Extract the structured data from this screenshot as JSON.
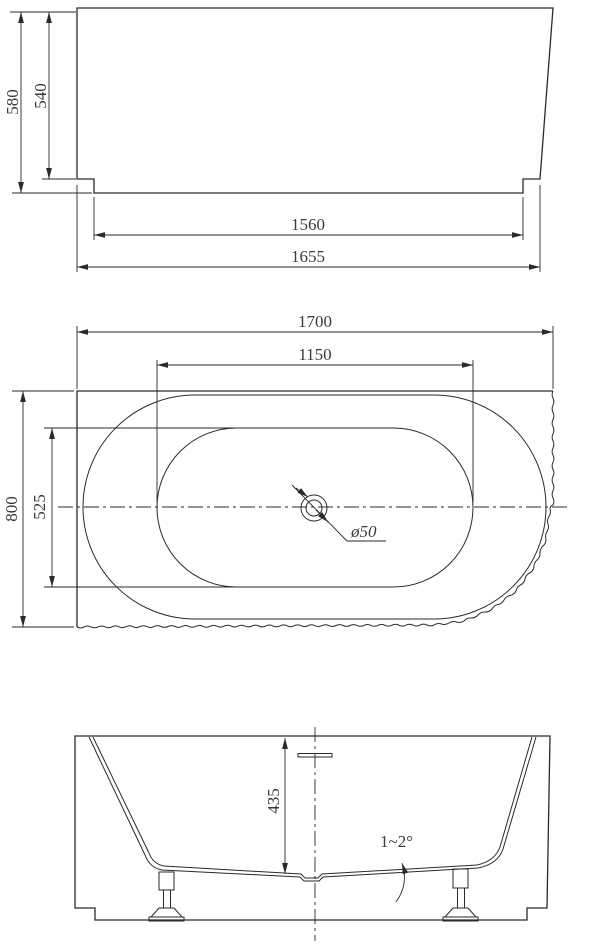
{
  "drawing": {
    "kind": "bathtub-technical-drawing",
    "views": [
      "front-elevation",
      "plan-view",
      "cross-section"
    ]
  },
  "dims": {
    "overall_height": "580",
    "body_height": "540",
    "base_length": "1560",
    "bottom_length": "1655",
    "overall_length": "1700",
    "inner_length": "1150",
    "overall_width": "800",
    "inner_width": "525",
    "drain_diameter": "ø50",
    "inner_depth": "435",
    "floor_slope": "1~2°"
  },
  "colors": {
    "line": "#2a2a2a",
    "text": "#3a3a3a",
    "background": "#ffffff"
  }
}
